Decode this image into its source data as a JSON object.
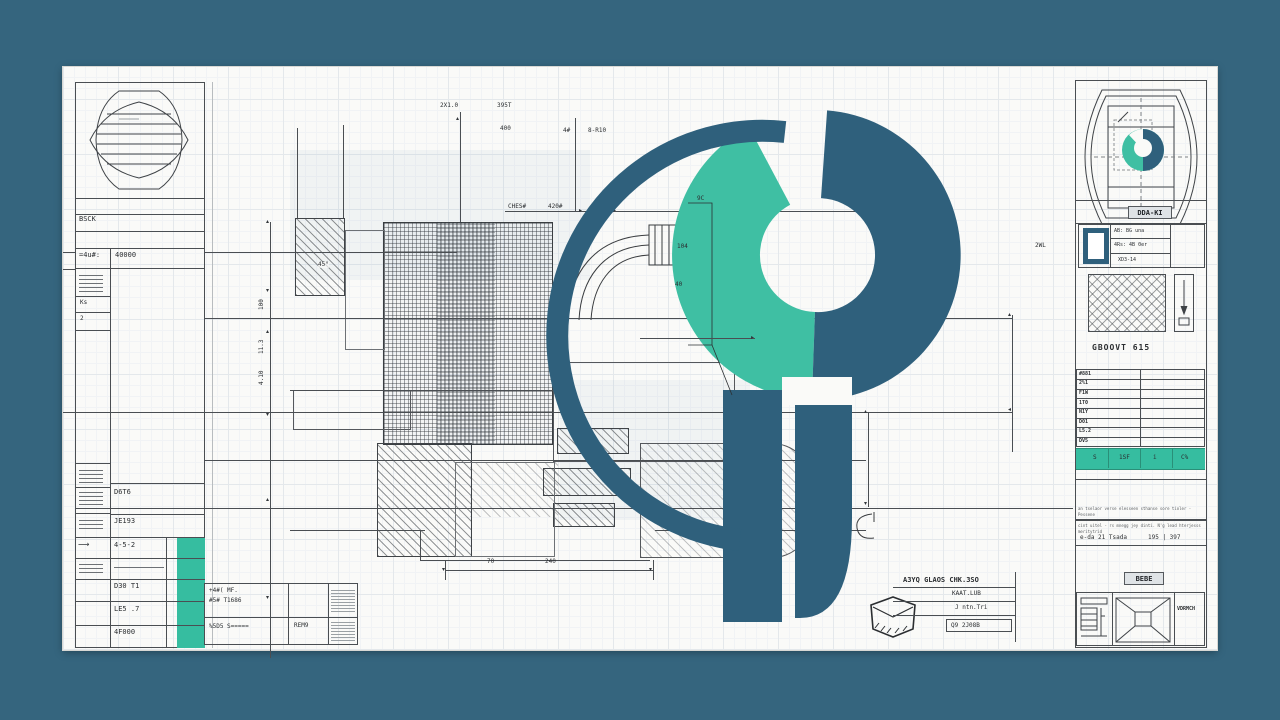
{
  "colors": {
    "background": "#35657e",
    "sheet": "#fafaf8",
    "logo_dark": "#2f607c",
    "logo_green": "#3fbfa3",
    "accent_teal": "#36bda0",
    "ink": "#4a4e52"
  },
  "left_panel": {
    "header_label": "BSCK",
    "spec_code": "=4u#:",
    "spec_value": "40000",
    "side_label_a": "Ks",
    "side_label_b": "2",
    "arrow_glyph": "⟶",
    "rows": [
      "D6T6",
      "JE193",
      "4-5-2",
      "D30 T1",
      "LE5 .7",
      "4F000"
    ]
  },
  "drawing": {
    "dim_top_a": "2X1.0",
    "dim_top_b": "395T",
    "dim_top_c": "400",
    "dim_top_d": "4#",
    "dim_top_e": "8-R10",
    "leader_a": "CHES#",
    "leader_b": "420#",
    "dim_left_a": "100",
    "dim_left_b": "11.3",
    "dim_left_c": "4.10",
    "angle_label": "45°",
    "wedge_a": "9C",
    "wedge_b": "104",
    "wedge_c": "40",
    "dim_bottom_a": "70",
    "dim_bottom_b": "240",
    "dim_right_a": "0UI",
    "dim_right_b": "2WL"
  },
  "right_panel": {
    "part_label": "DDA-KI",
    "info_rows": [
      "AB: BG una",
      "4Rs: 4B 0er",
      "XD3-14"
    ],
    "section_title": "GBOOVT 615",
    "codes": [
      "#881",
      "2%1",
      "F1W",
      "1T0",
      "N1Y",
      "D01",
      "L5.2",
      "DV5"
    ],
    "teal_cells": [
      "S",
      "1SF",
      "i",
      "C%"
    ],
    "notes_a": "an tselaor verse elesseen   sthanse sore tioler - Pessene",
    "notes_b": "cint uitel - rs mnegg jey dinti.  N'g lead hterjesss meritytrid",
    "notes_c": "e-da 21 Tsada",
    "notes_d": "195 | 397",
    "stamp_label": "BEBE",
    "corner_label": "VDRMCH"
  },
  "bottom_blocks": {
    "t1_r1a": "+4#( MF.",
    "t1_r1b": "#5# T1686",
    "t1_r2a": "%5D5 S=====",
    "t1_r2b": "REM9",
    "sig_line1": "A3YQ GLAOS CHK.3SO",
    "sig_line2": "KAAT.LUB",
    "sig_line3": "J ntn.Tri",
    "sig_line4": "Q9 2J08B"
  }
}
